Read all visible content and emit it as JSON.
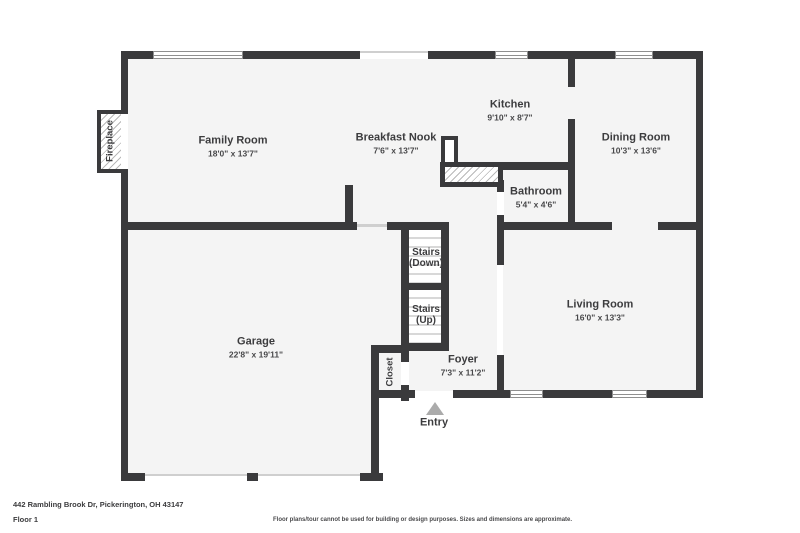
{
  "meta": {
    "address": "442 Rambling Brook Dr, Pickerington, OH 43147",
    "floor_label": "Floor 1",
    "disclaimer": "Floor plans/tour cannot be used for building or design purposes. Sizes and dimensions are approximate."
  },
  "colors": {
    "wall": "#3a3a3c",
    "floor": "#f4f4f4",
    "entry_arrow": "#ababab"
  },
  "rooms": {
    "family_room": {
      "name": "Family Room",
      "dims": "18'0\" x 13'7\""
    },
    "breakfast_nook": {
      "name": "Breakfast Nook",
      "dims": "7'6\" x 13'7\""
    },
    "kitchen": {
      "name": "Kitchen",
      "dims": "9'10\" x 8'7\""
    },
    "dining_room": {
      "name": "Dining Room",
      "dims": "10'3\" x 13'6\""
    },
    "bathroom": {
      "name": "Bathroom",
      "dims": "5'4\" x 4'6\""
    },
    "living_room": {
      "name": "Living Room",
      "dims": "16'0\" x 13'3\""
    },
    "garage": {
      "name": "Garage",
      "dims": "22'8\" x 19'11\""
    },
    "foyer": {
      "name": "Foyer",
      "dims": "7'3\" x 11'2\""
    },
    "stairs_down": {
      "name": "Stairs",
      "sub": "(Down)"
    },
    "stairs_up": {
      "name": "Stairs",
      "sub": "(Up)"
    },
    "closet": {
      "name": "Closet"
    },
    "fireplace": {
      "name": "Fireplace"
    },
    "entry": {
      "name": "Entry"
    }
  }
}
